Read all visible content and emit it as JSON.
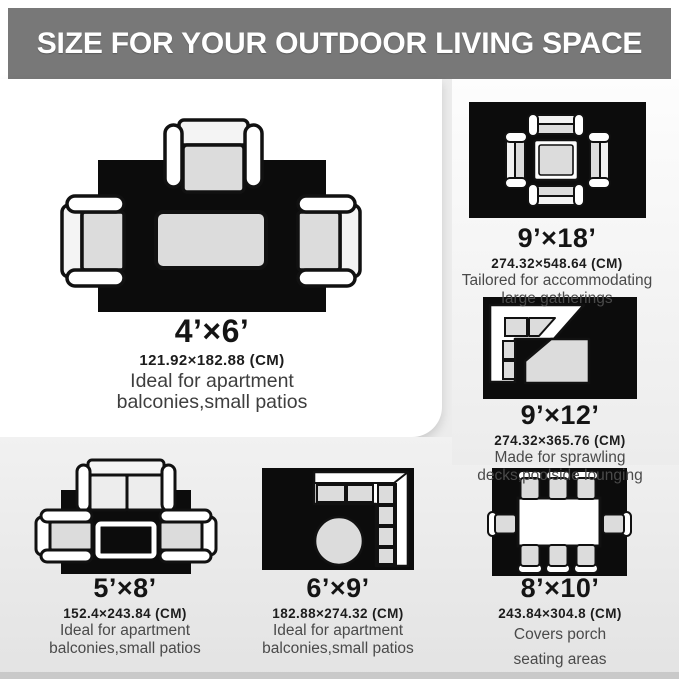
{
  "header": {
    "title": "SIZE FOR YOUR OUTDOOR LIVING SPACE"
  },
  "colors": {
    "header_bg": "#787878",
    "header_text": "#ffffff",
    "rug_black": "#0c0c0c",
    "furniture_white": "#ffffff",
    "cushion_gray": "#dcdcdc",
    "mid_section_bg": "#ececec",
    "bottom_section_bg": "#e9e9e9",
    "size_text": "#141414",
    "desc_text": "#4a4a4a"
  },
  "panels": [
    {
      "id": "4x6",
      "size_label": "4’×6’",
      "cm_label": "121.92×182.88 (CM)",
      "desc_lines": [
        "Ideal for apartment",
        "balconies,small patios"
      ],
      "diagram": "three-armchairs-coffee-table-rug"
    },
    {
      "id": "9x18",
      "size_label": "9’×18’",
      "cm_label": "274.32×548.64 (CM)",
      "desc_lines": [
        "Tailored for accommodating",
        "large gatherings"
      ],
      "diagram": "square-table-four-chairs-rug"
    },
    {
      "id": "9x12",
      "size_label": "9’×12’",
      "cm_label": "274.32×365.76 (CM)",
      "desc_lines": [
        "Made for sprawling",
        "decks,poolside lounging"
      ],
      "diagram": "corner-sectional-chaise-rug"
    },
    {
      "id": "5x8",
      "size_label": "5’×8’",
      "cm_label": "152.4×243.84 (CM)",
      "desc_lines": [
        "Ideal for apartment",
        "balconies,small patios"
      ],
      "diagram": "sofa-two-armchairs-coffee-table-rug"
    },
    {
      "id": "6x9",
      "size_label": "6’×9’",
      "cm_label": "182.88×274.32 (CM)",
      "desc_lines": [
        "Ideal for apartment",
        "balconies,small patios"
      ],
      "diagram": "corner-sectional-round-ottoman-rug"
    },
    {
      "id": "8x10",
      "size_label": "8’×10’",
      "cm_label": "243.84×304.8 (CM)",
      "desc_lines": [
        "Covers porch",
        "seating areas"
      ],
      "diagram": "dining-table-eight-chairs-rug"
    }
  ]
}
